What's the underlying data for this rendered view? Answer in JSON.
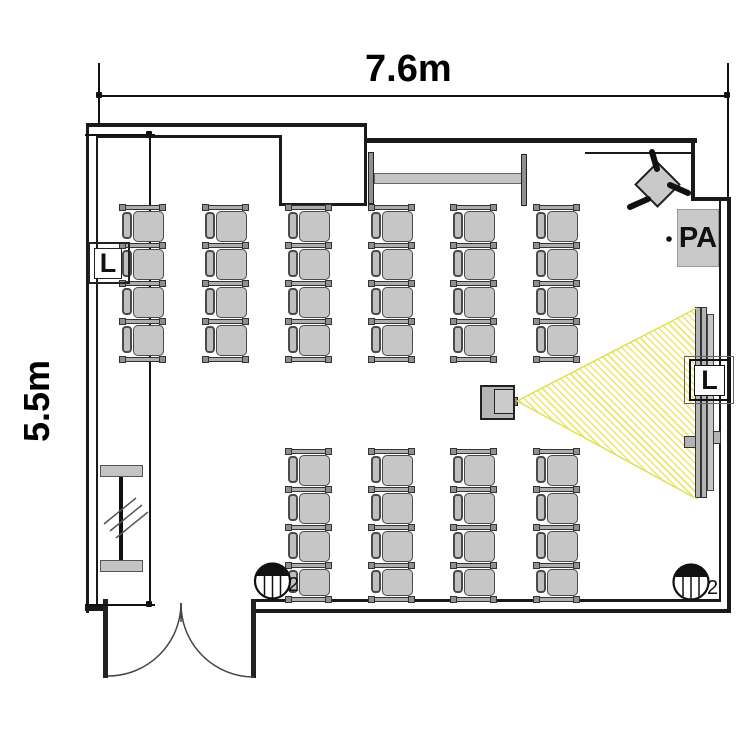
{
  "floor_plan": {
    "room_width_label": "7.6m",
    "room_height_label": "5.5m",
    "speaker_left_label": "L",
    "speaker_right_label": "L",
    "pa_label": "PA",
    "marker_left_label": "2",
    "marker_right_label": "2"
  },
  "seating": {
    "unit_width": 45,
    "bar_height": 5,
    "upper_block": {
      "columns_x": [
        120,
        203,
        286,
        369,
        451,
        534
      ],
      "bars_y": [
        205,
        243,
        281,
        319,
        357
      ]
    },
    "lower_block": {
      "columns_x": [
        286,
        369,
        451,
        534
      ],
      "bars_y": [
        449,
        487,
        525,
        563,
        597
      ]
    }
  },
  "colors": {
    "wall": "#1a1a1a",
    "seat_fill": "#c6c6c6",
    "seat_border": "#4a4a4a",
    "backrest_fill": "#bfbfbf",
    "bar_fill": "#aeaeae",
    "bar_border": "#333333",
    "cap_fill": "#8f8f8f",
    "equipment_fill": "#c9c9c9",
    "beam_yellow": "#e8e86a",
    "line_dark": "#444444"
  }
}
